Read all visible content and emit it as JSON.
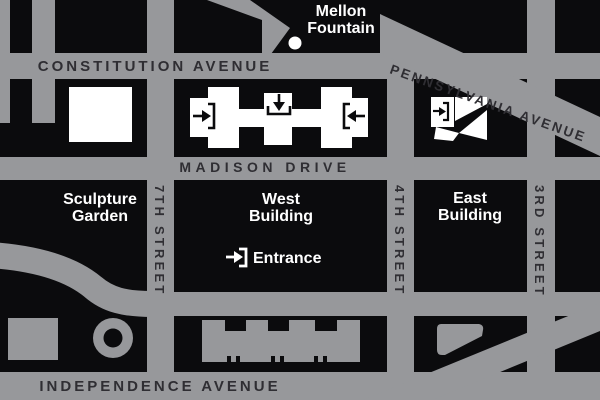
{
  "map": {
    "streets": {
      "constitution": "CONSTITUTION AVENUE",
      "pennsylvania": "PENNSYLVANIA AVENUE",
      "madison": "MADISON DRIVE",
      "independence": "INDEPENDENCE AVENUE",
      "seventh": "7TH STREET",
      "fourth": "4TH STREET",
      "third": "3RD STREET"
    },
    "landmarks": {
      "mellon_fountain": {
        "line1": "Mellon",
        "line2": "Fountain"
      },
      "sculpture_garden": {
        "line1": "Sculpture",
        "line2": "Garden"
      },
      "west_building": {
        "line1": "West",
        "line2": "Building"
      },
      "east_building": {
        "line1": "East",
        "line2": "Building"
      },
      "entrance": "Entrance"
    },
    "colors": {
      "street_gray": "#97989B",
      "block_black": "#0B0B0D",
      "street_label_dark": "#2F2E33",
      "label_white": "#FFFFFF"
    }
  }
}
